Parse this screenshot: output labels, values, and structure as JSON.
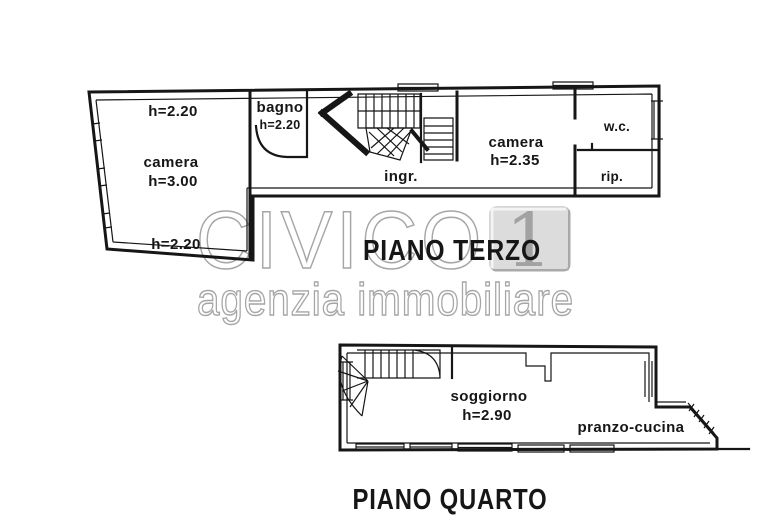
{
  "watermark": {
    "brand": "CIVICO",
    "badge_number": "1",
    "tagline": "agenzia immobiliare"
  },
  "plans": {
    "terzo": {
      "title": "PIANO TERZO",
      "wall_height_top": "h=2.20",
      "wall_height_bottom": "h=2.20",
      "rooms": {
        "camera_left": {
          "label": "camera",
          "height": "h=3.00"
        },
        "bagno": {
          "label": "bagno",
          "height": "h=2.20"
        },
        "ingresso": {
          "label": "ingr."
        },
        "camera_right": {
          "label": "camera",
          "height": "h=2.35"
        },
        "wc": {
          "label": "w.c."
        },
        "rip": {
          "label": "rip."
        }
      }
    },
    "quarto": {
      "title": "PIANO QUARTO",
      "rooms": {
        "soggiorno": {
          "label": "soggiorno",
          "height": "h=2.90"
        },
        "pranzo_cucina": {
          "label": "pranzo-cucina"
        }
      }
    }
  },
  "colors": {
    "ink": "#161616",
    "watermark": "#a6a6a6",
    "badge_fill": "#dcdcdc",
    "badge_border": "#c6c6c6",
    "badge_highlight": "#f4f4f4",
    "badge_shadow": "#a9a9a9",
    "badge_digit": "#a2a2a2",
    "background": "#ffffff"
  }
}
